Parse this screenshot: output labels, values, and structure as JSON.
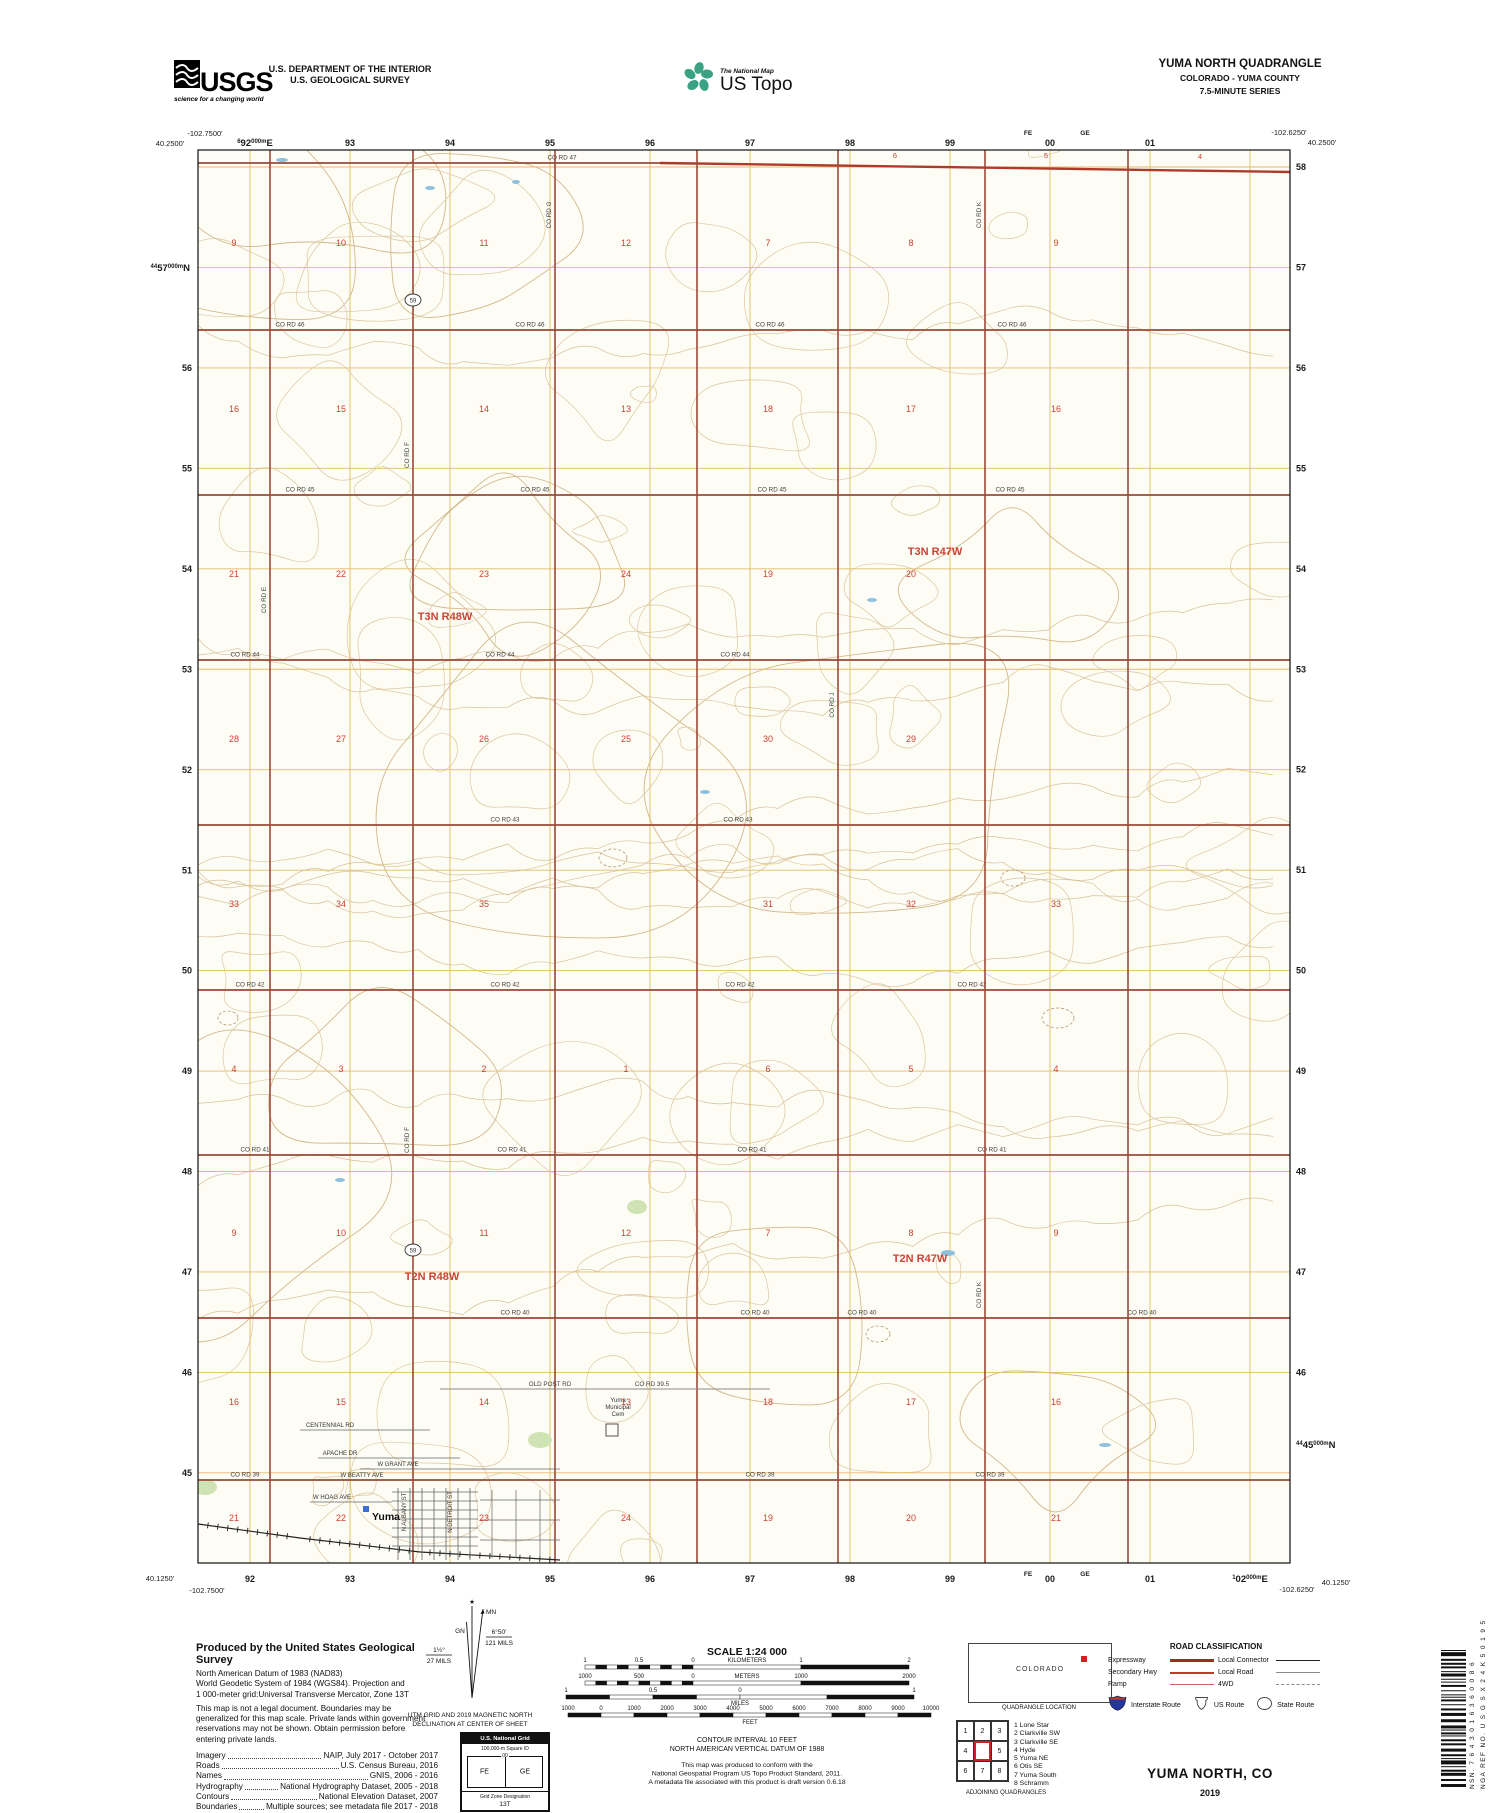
{
  "header": {
    "usgs_wordmark": "USGS",
    "usgs_tagline": "science for a changing world",
    "dept1": "U.S. DEPARTMENT OF THE INTERIOR",
    "dept2": "U.S. GEOLOGICAL SURVEY",
    "tnm_small": "The National Map",
    "tnm_big": "US Topo",
    "quad_title": "YUMA NORTH QUADRANGLE",
    "quad_state": "COLORADO - YUMA COUNTY",
    "quad_series": "7.5-MINUTE SERIES"
  },
  "map": {
    "corners": {
      "tl_lon": "-102.7500'",
      "tl_lat": "40.2500'",
      "tr_lon": "-102.6250'",
      "tr_lat": "40.2500'",
      "bl_lat": "40.1250'",
      "bl_lon": "-102.7500'",
      "br_lon": "-102.6250'",
      "br_lat": "40.1250'"
    },
    "gridrefs": {
      "top_first": {
        "pre": "6",
        "big": "92",
        "post": "000m",
        "dir": "E"
      },
      "bottom_last": {
        "pre": "1",
        "big": "02",
        "post": "000m",
        "dir": "E"
      },
      "left_first": {
        "pre": "44",
        "big": "57",
        "post": "000m",
        "dir": "N"
      },
      "right_last": {
        "pre": "44",
        "big": "45",
        "post": "000m",
        "dir": "N"
      }
    },
    "top_labels": [
      "93",
      "94",
      "95",
      "96",
      "97",
      "98",
      "99",
      "00",
      "01"
    ],
    "bottom_labels": [
      "92",
      "93",
      "94",
      "95",
      "96",
      "97",
      "98",
      "99",
      "00",
      "01"
    ],
    "left_labels": [
      "56",
      "55",
      "54",
      "53",
      "52",
      "51",
      "50",
      "49",
      "48",
      "47",
      "46",
      "45"
    ],
    "right_labels": [
      "58",
      "57",
      "56",
      "55",
      "54",
      "53",
      "52",
      "51",
      "50",
      "49",
      "48",
      "47",
      "46"
    ],
    "square_ids": [
      "FE",
      "GE"
    ],
    "townships": [
      {
        "t": "T3N R48W",
        "x": 445,
        "y": 620
      },
      {
        "t": "T3N R47W",
        "x": 935,
        "y": 555
      },
      {
        "t": "T2N R48W",
        "x": 432,
        "y": 1280
      },
      {
        "t": "T2N R47W",
        "x": 920,
        "y": 1262
      }
    ],
    "sections_rows": [
      [
        "9",
        "10",
        "11",
        "12",
        "7",
        "8",
        "9"
      ],
      [
        "16",
        "15",
        "14",
        "13",
        "18",
        "17",
        "16"
      ],
      [
        "21",
        "22",
        "23",
        "24",
        "19",
        "20",
        ""
      ],
      [
        "28",
        "27",
        "26",
        "25",
        "30",
        "29",
        ""
      ],
      [
        "33",
        "34",
        "35",
        "",
        "31",
        "32",
        "33"
      ],
      [
        "4",
        "3",
        "2",
        "1",
        "6",
        "5",
        "4"
      ],
      [
        "9",
        "10",
        "11",
        "12",
        "7",
        "8",
        "9"
      ],
      [
        "16",
        "15",
        "14",
        "13",
        "18",
        "17",
        "16"
      ],
      [
        "21",
        "22",
        "23",
        "24",
        "19",
        "20",
        "21"
      ]
    ],
    "partial_top_sections": [
      {
        "t": "6",
        "x": 895,
        "y": 158
      },
      {
        "t": "5",
        "x": 1046,
        "y": 158
      },
      {
        "t": "4",
        "x": 1200,
        "y": 159
      }
    ],
    "h_roads": [
      {
        "label": "CO RD 47",
        "y": 163,
        "lx": [
          562
        ]
      },
      {
        "label": "CO RD 46",
        "y": 330,
        "lx": [
          290,
          530,
          770,
          1012
        ]
      },
      {
        "label": "CO RD 45",
        "y": 495,
        "lx": [
          300,
          535,
          772,
          1010
        ]
      },
      {
        "label": "CO RD 44",
        "y": 660,
        "lx": [
          245,
          500,
          735
        ]
      },
      {
        "label": "CO RD 43",
        "y": 825,
        "lx": [
          505,
          738
        ]
      },
      {
        "label": "CO RD 42",
        "y": 990,
        "lx": [
          250,
          505,
          740,
          972
        ]
      },
      {
        "label": "CO RD 41",
        "y": 1155,
        "lx": [
          255,
          512,
          752,
          992
        ]
      },
      {
        "label": "CO RD 40",
        "y": 1318,
        "lx": [
          515,
          755,
          862,
          1142
        ]
      },
      {
        "label": "CO RD 39",
        "y": 1480,
        "lx": [
          245,
          760,
          990
        ]
      }
    ],
    "half_road": {
      "label": "CO RD 39.5",
      "y": 1389,
      "x1": 440,
      "x2": 770,
      "lx": 652
    },
    "old_post": {
      "label": "OLD POST RD",
      "lx": 550,
      "y": 1389
    },
    "v_roads": [
      {
        "label": "CO RD E",
        "x": 270,
        "ly": [
          600
        ]
      },
      {
        "label": "CO RD F",
        "x": 413,
        "ly": [
          455,
          1140
        ]
      },
      {
        "label": "CO RD G",
        "x": 555,
        "ly": [
          215
        ]
      },
      {
        "label": "",
        "x": 697,
        "ly": []
      },
      {
        "label": "CO RD J",
        "x": 838,
        "ly": [
          705
        ]
      },
      {
        "label": "CO RD K",
        "x": 985,
        "ly": [
          215,
          1295
        ]
      },
      {
        "label": "",
        "x": 1128,
        "ly": []
      }
    ],
    "route_shields": [
      {
        "num": "59",
        "x": 413,
        "y": 300
      },
      {
        "num": "59",
        "x": 413,
        "y": 1250
      }
    ],
    "town": {
      "name": "Yuma",
      "x": 386,
      "y": 1520
    },
    "cemetery": {
      "lines": [
        "Yuma",
        "Municipal",
        "Cem"
      ],
      "x": 618,
      "y": 1402
    },
    "street_labels": [
      {
        "t": "APACHE DR",
        "x": 340,
        "y": 1455,
        "rot": false
      },
      {
        "t": "W GRANT AVE",
        "x": 398,
        "y": 1466,
        "rot": false
      },
      {
        "t": "W BEATTY AVE",
        "x": 362,
        "y": 1477,
        "rot": false
      },
      {
        "t": "W HOAG AVE",
        "x": 332,
        "y": 1499,
        "rot": false
      },
      {
        "t": "CENTENNIAL RD",
        "x": 330,
        "y": 1427,
        "rot": false
      },
      {
        "t": "N ALBANY ST",
        "x": 406,
        "y": 1512,
        "rot": true
      },
      {
        "t": "N DETROIT ST",
        "x": 452,
        "y": 1512,
        "rot": true
      }
    ]
  },
  "footer": {
    "produced_title": "Produced by the United States Geological Survey",
    "datum_lines": [
      "North American Datum of 1983 (NAD83)",
      "World Geodetic System of 1984 (WGS84).  Projection and",
      "1 000-meter grid:Universal Transverse Mercator, Zone 13T"
    ],
    "legal_lines": [
      "This map is not a legal document. Boundaries may be",
      "generalized for this map scale. Private lands within government",
      "reservations may not be shown. Obtain permission before",
      "entering private lands."
    ],
    "credits": [
      {
        "k": "Imagery",
        "v": "NAIP, July 2017 - October 2017"
      },
      {
        "k": "Roads",
        "v": "U.S. Census Bureau, 2016"
      },
      {
        "k": "Names",
        "v": "GNIS, 2006 - 2016"
      },
      {
        "k": "Hydrography",
        "v": "National Hydrography Dataset, 2005 - 2018"
      },
      {
        "k": "Contours",
        "v": "National Elevation Dataset, 2007"
      },
      {
        "k": "Boundaries",
        "v": "Multiple sources; see metadata file 2017 - 2018"
      },
      {
        "k": "Public Land Survey System",
        "v": "BLM, 2018"
      },
      {
        "k": "Wetlands",
        "v": "FWS National Wetlands Inventory 1975"
      }
    ],
    "declination": {
      "mn": "MN",
      "gn": "GN",
      "star": "★",
      "left_deg": "1½°",
      "left_mils": "27 MILS",
      "right_deg": "6°50'",
      "right_mils": "121 M0ILS",
      "right_mils_fix": "121 MILS",
      "caption1": "UTM GRID AND 2019 MAGNETIC NORTH",
      "caption2": "DECLINATION AT CENTER OF SHEET"
    },
    "usng": {
      "title": "U.S. National Grid",
      "sq_label": "100,000-m Square ID",
      "divider_label": "00",
      "squares": [
        "FE",
        "GE"
      ],
      "gzd_label": "Grid Zone Designation",
      "gzd": "13T"
    },
    "scale": {
      "title": "SCALE 1:24 000",
      "km_labels": [
        "1",
        "0.5",
        "0",
        "KILOMETERS",
        "1",
        "2"
      ],
      "m_labels": [
        "1000",
        "500",
        "0",
        "METERS",
        "1000",
        "2000"
      ],
      "mi_labels": [
        "1",
        "0.5",
        "0",
        "1"
      ],
      "mi_unit": "MILES",
      "ft_labels": [
        "1000",
        "0",
        "1000",
        "2000",
        "3000",
        "4000",
        "5000",
        "6000",
        "7000",
        "8000",
        "9000",
        "10000"
      ],
      "ft_unit": "FEET",
      "contour1": "CONTOUR INTERVAL 10 FEET",
      "contour2": "NORTH AMERICAN VERTICAL DATUM OF 1988",
      "conform": [
        "This map was produced to conform with the",
        "National Geospatial Program US Topo Product Standard, 2011.",
        "A metadata file associated with this product is draft version 0.6.18"
      ]
    },
    "quadloc": {
      "state": "COLORADO",
      "caption": "QUADRANGLE LOCATION"
    },
    "adjoining": {
      "cells": [
        "1",
        "2",
        "3",
        "4",
        "",
        "5",
        "6",
        "7",
        "8"
      ],
      "names": [
        "1 Lone Star",
        "2 Clarkville SW",
        "3 Clarkville SE",
        "4 Hyde",
        "5 Yuma NE",
        "6 Otis SE",
        "7 Yuma South",
        "8 Schramm"
      ],
      "caption": "ADJOINING QUADRANGLES"
    },
    "roadclass": {
      "title": "ROAD CLASSIFICATION",
      "left": [
        {
          "label": "Expressway",
          "style": "expressway"
        },
        {
          "label": "Secondary Hwy",
          "style": "secondary"
        },
        {
          "label": "Ramp",
          "style": "ramp"
        }
      ],
      "right": [
        {
          "label": "Local Connector",
          "style": "connector"
        },
        {
          "label": "Local Road",
          "style": "local"
        },
        {
          "label": "4WD",
          "style": "fourwd"
        }
      ],
      "shields": [
        {
          "label": "Interstate Route",
          "type": "interstate"
        },
        {
          "label": "US Route",
          "type": "us"
        },
        {
          "label": "State Route",
          "type": "state"
        }
      ]
    },
    "sheet_title": "YUMA NORTH,  CO",
    "sheet_year": "2019",
    "barcode": {
      "nsn_label": "NSN.",
      "nsn": "7643016360086",
      "nga_label": "NGA REF NO.",
      "nga": "USGSX24K50195"
    }
  }
}
